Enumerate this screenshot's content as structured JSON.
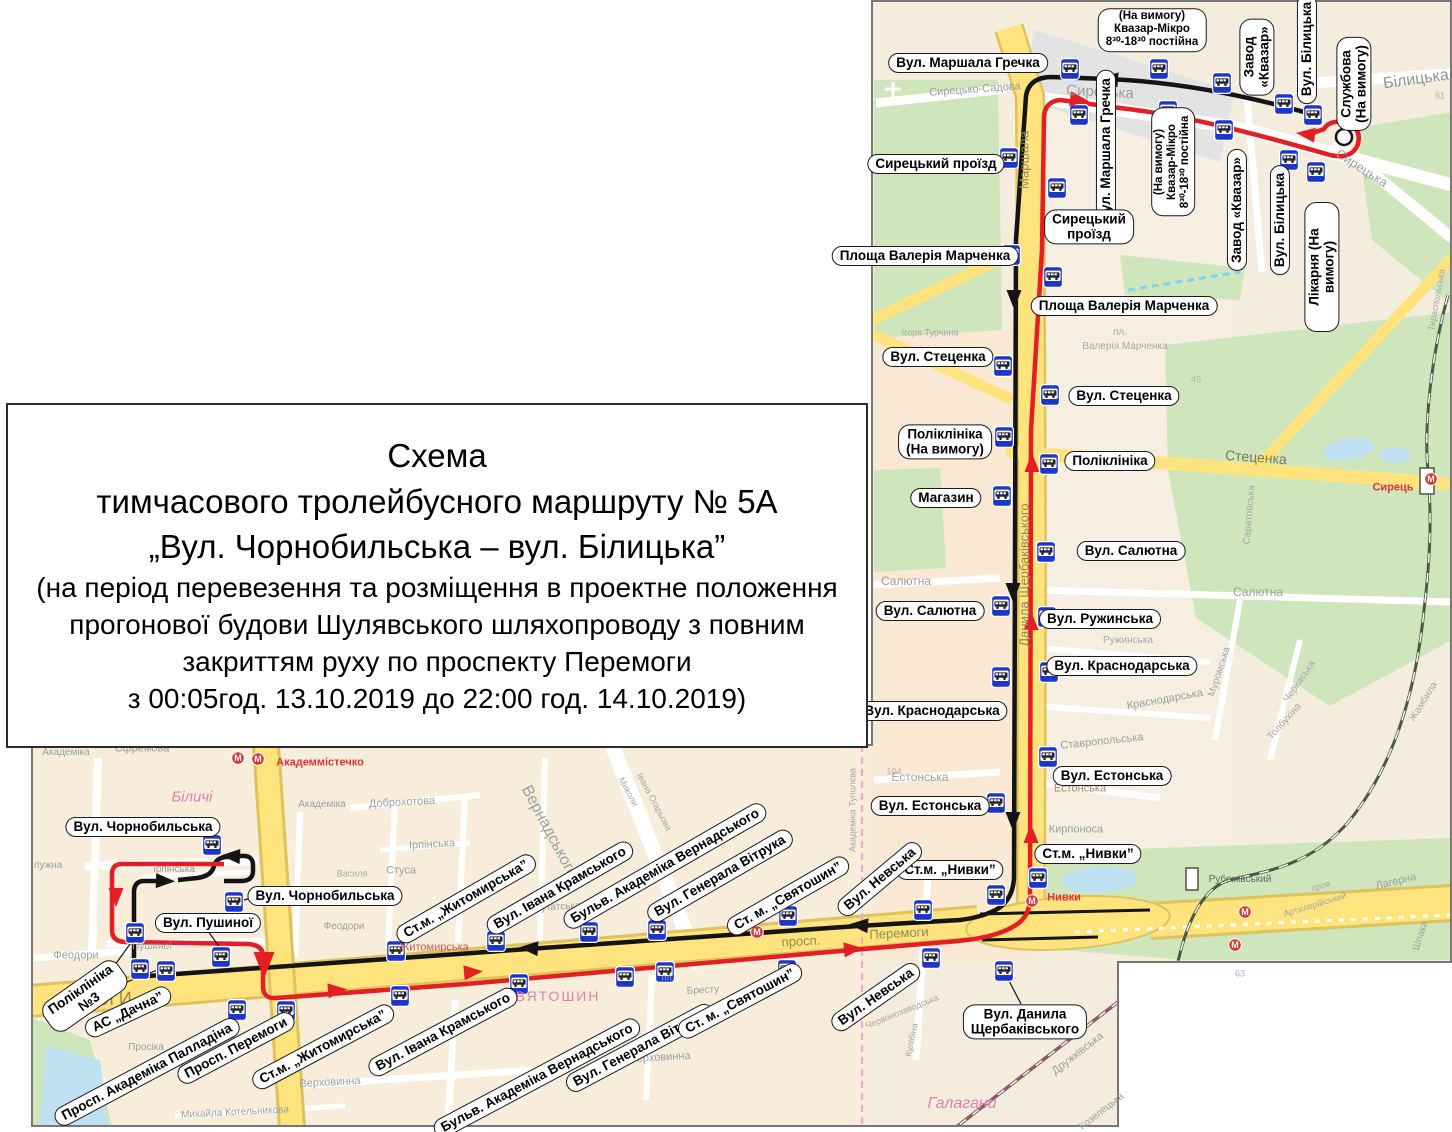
{
  "title_box": {
    "lines": [
      "Схема",
      "тимчасового тролейбусного маршруту  № 5А",
      "„Вул. Чорнобильська – вул. Білицька”",
      "(на період перевезення та розміщення в проектне положення",
      "прогонової будови Шулявського шляхопроводу з повним",
      "закриттям руху по проспекту Перемоги",
      "з 00:05год. 13.10.2019 до 22:00 год. 14.10.2019)"
    ]
  },
  "colors": {
    "route_outbound": "#141414",
    "route_return": "#e31e24",
    "road_main": "#ffe37d",
    "road_casing": "#ddc35e",
    "park_green": "#cfe6bc",
    "water_blue": "#bfe0f0",
    "label_border": "#1a1a1a"
  },
  "map": {
    "stop_labels": [
      {
        "t": "Вул. Маршала Гречка",
        "x": 968,
        "y": 63,
        "r": 0
      },
      {
        "t": "Сирецький проїзд",
        "x": 936,
        "y": 164,
        "r": 0
      },
      {
        "t": "Площа Валерія Марченка",
        "x": 925,
        "y": 256,
        "r": 0
      },
      {
        "t": "Вул. Стеценка",
        "x": 938,
        "y": 357,
        "r": 0
      },
      {
        "t": "Поліклініка\n(На вимогу)",
        "x": 945,
        "y": 442,
        "r": 0
      },
      {
        "t": "Магазин",
        "x": 946,
        "y": 498,
        "r": 0
      },
      {
        "t": "Вул. Салютна",
        "x": 930,
        "y": 611,
        "r": 0
      },
      {
        "t": "Вул. Краснодарська",
        "x": 932,
        "y": 711,
        "r": 0
      },
      {
        "t": "Вул. Естонська",
        "x": 930,
        "y": 806,
        "r": 0
      },
      {
        "t": "Ст.м. „Нивки”",
        "x": 950,
        "y": 870,
        "r": 0
      },
      {
        "t": "Вул. Маршала Гречка",
        "x": 1106,
        "y": 150,
        "r": -90
      },
      {
        "t": "(На вимогу)\nКвазар-Мікро\n8³⁰-18³⁰ постійна",
        "x": 1173,
        "y": 162,
        "r": -90,
        "fs": 11.5
      },
      {
        "t": "Сирецький\nпроїзд",
        "x": 1089,
        "y": 227,
        "r": 0
      },
      {
        "t": "Площа Валерія Марченка",
        "x": 1124,
        "y": 306,
        "r": 0
      },
      {
        "t": "Вул. Стеценка",
        "x": 1124,
        "y": 396,
        "r": 0
      },
      {
        "t": "Поліклініка",
        "x": 1110,
        "y": 461,
        "r": 0
      },
      {
        "t": "Вул. Салютна",
        "x": 1131,
        "y": 551,
        "r": 0
      },
      {
        "t": "Вул. Ружинська",
        "x": 1100,
        "y": 619,
        "r": 0
      },
      {
        "t": "Вул. Краснодарська",
        "x": 1122,
        "y": 666,
        "r": 0
      },
      {
        "t": "Вул. Естонська",
        "x": 1112,
        "y": 776,
        "r": 0
      },
      {
        "t": "Ст.м. „Нивки”",
        "x": 1088,
        "y": 854,
        "r": 0
      },
      {
        "t": "Вул. Данила\nЩербаківського",
        "x": 1025,
        "y": 1022,
        "r": 0
      },
      {
        "t": "(На вимогу)\nКвазар-Мікро\n8³⁰-18³⁰ постійна",
        "x": 1152,
        "y": 30,
        "r": 0,
        "fs": 11.5
      },
      {
        "t": "Завод\n«Квазар»",
        "x": 1257,
        "y": 57,
        "r": -90
      },
      {
        "t": "Вул. Білицька",
        "x": 1307,
        "y": 49,
        "r": -90
      },
      {
        "t": "Службова\n(На вимогу)",
        "x": 1354,
        "y": 84,
        "r": -90
      },
      {
        "t": "Завод «Квазар»",
        "x": 1237,
        "y": 210,
        "r": -90
      },
      {
        "t": "Вул. Білицька",
        "x": 1280,
        "y": 220,
        "r": -90
      },
      {
        "t": "Лікарня (На вимогу)",
        "x": 1322,
        "y": 267,
        "r": -90
      },
      {
        "t": "Вул. Чорнобильська",
        "x": 143,
        "y": 827,
        "r": 0
      },
      {
        "t": "Вул. Чорнобильська",
        "x": 325,
        "y": 896,
        "r": 0
      },
      {
        "t": "Вул. Пушиної",
        "x": 208,
        "y": 923,
        "r": 0
      },
      {
        "t": "Поліклініка\n№3",
        "x": 85,
        "y": 996,
        "r": -35
      },
      {
        "t": "АС „Дачна”",
        "x": 128,
        "y": 1012,
        "r": -25
      },
      {
        "t": "Просп. Академіка Палладіна",
        "x": 147,
        "y": 1072,
        "r": -28
      },
      {
        "t": "Просп. Перемоги",
        "x": 236,
        "y": 1048,
        "r": -28
      },
      {
        "t": "Ст.м. „Житомирська”",
        "x": 323,
        "y": 1047,
        "r": -28
      },
      {
        "t": "Вул. Івана Крамського",
        "x": 443,
        "y": 1032,
        "r": -28
      },
      {
        "t": "Бульв. Академіка Вернадського",
        "x": 537,
        "y": 1078,
        "r": -28
      },
      {
        "t": "Вул. Генерала Вітрука",
        "x": 640,
        "y": 1048,
        "r": -28
      },
      {
        "t": "Ст. м. „Святошин”",
        "x": 740,
        "y": 1001,
        "r": -28
      },
      {
        "t": "Вул. Невська",
        "x": 876,
        "y": 997,
        "r": -35
      },
      {
        "t": "Ст.м. „Житомирська”",
        "x": 466,
        "y": 899,
        "r": -30
      },
      {
        "t": "Вул. Івана Крамського",
        "x": 560,
        "y": 888,
        "r": -30
      },
      {
        "t": "Бульв. Академіка Вернадського",
        "x": 665,
        "y": 866,
        "r": -30
      },
      {
        "t": "Вул. Генерала Вітрука",
        "x": 720,
        "y": 876,
        "r": -30
      },
      {
        "t": "Ст. м. „Святошин”",
        "x": 788,
        "y": 896,
        "r": -30
      },
      {
        "t": "Вул. Невська",
        "x": 880,
        "y": 879,
        "r": -40
      }
    ],
    "street_names": [
      {
        "t": "Сирецько-Садова",
        "x": 975,
        "y": 90,
        "r": -4,
        "s": 11,
        "c": "#9aa0a0"
      },
      {
        "t": "Сирецька",
        "x": 1100,
        "y": 92,
        "r": 3,
        "s": 15,
        "c": "#9aa0a0"
      },
      {
        "t": "Сирецька",
        "x": 1362,
        "y": 168,
        "r": 33,
        "s": 13,
        "c": "#9aa0a0"
      },
      {
        "t": "Білицька",
        "x": 1416,
        "y": 80,
        "r": -8,
        "s": 16,
        "c": "#8f968f"
      },
      {
        "t": "Маршала",
        "x": 1024,
        "y": 160,
        "r": -90,
        "s": 13,
        "c": "#8f8a5a"
      },
      {
        "t": "Данила Щербаківського",
        "x": 1024,
        "y": 575,
        "r": -90,
        "s": 13,
        "c": "#8f8a5a"
      },
      {
        "t": "Стеценка",
        "x": 1256,
        "y": 457,
        "r": 4,
        "s": 14,
        "c": "#7d7a4e"
      },
      {
        "t": "Ігоря Турчина",
        "x": 930,
        "y": 333,
        "r": 0,
        "s": 9,
        "c": "#a8a8a8"
      },
      {
        "t": "пл.",
        "x": 1120,
        "y": 333,
        "r": 0,
        "s": 10,
        "c": "#a8a8a8"
      },
      {
        "t": "Валерія Марченка",
        "x": 1125,
        "y": 347,
        "r": 0,
        "s": 10,
        "c": "#a8a8a8"
      },
      {
        "t": "Салютна",
        "x": 906,
        "y": 581,
        "r": 0,
        "s": 12,
        "c": "#9aa0a0"
      },
      {
        "t": "Салютна",
        "x": 1258,
        "y": 592,
        "r": 0,
        "s": 12,
        "c": "#9aa0a0"
      },
      {
        "t": "Саратовська",
        "x": 1250,
        "y": 515,
        "r": -85,
        "s": 10,
        "c": "#a8a8a8"
      },
      {
        "t": "Ружинська",
        "x": 1128,
        "y": 641,
        "r": 0,
        "s": 10,
        "c": "#a8a8a8"
      },
      {
        "t": "Краснодарська",
        "x": 1165,
        "y": 700,
        "r": -10,
        "s": 11,
        "c": "#9aa0a0"
      },
      {
        "t": "Ставропольська",
        "x": 1102,
        "y": 742,
        "r": -6,
        "s": 11,
        "c": "#9aa0a0"
      },
      {
        "t": "Естонська",
        "x": 920,
        "y": 777,
        "r": 0,
        "s": 12,
        "c": "#9aa0a0"
      },
      {
        "t": "Естонська",
        "x": 1080,
        "y": 789,
        "r": 0,
        "s": 11,
        "c": "#b5825a"
      },
      {
        "t": "Кирпоноса",
        "x": 1076,
        "y": 830,
        "r": 0,
        "s": 11,
        "c": "#9aa0a0"
      },
      {
        "t": "Нивки",
        "x": 1064,
        "y": 898,
        "r": 0,
        "s": 11,
        "c": "#e03434",
        "w": 1
      },
      {
        "t": "Сирець",
        "x": 1393,
        "y": 488,
        "r": 0,
        "s": 11,
        "c": "#e03434",
        "w": 1
      },
      {
        "t": "Рубежівський",
        "x": 1240,
        "y": 880,
        "r": 0,
        "s": 10,
        "c": "#666666"
      },
      {
        "t": "пров.",
        "x": 1322,
        "y": 886,
        "r": -17,
        "s": 9,
        "c": "#a8a8a8"
      },
      {
        "t": "Артилерійський",
        "x": 1315,
        "y": 905,
        "r": -17,
        "s": 9,
        "c": "#a8a8a8"
      },
      {
        "t": "Лагерна",
        "x": 1396,
        "y": 882,
        "r": -14,
        "s": 11,
        "c": "#9aa0a0"
      },
      {
        "t": "Шпака",
        "x": 1421,
        "y": 936,
        "r": -72,
        "s": 10,
        "c": "#9aa0a0"
      },
      {
        "t": "Тираспольська",
        "x": 1437,
        "y": 300,
        "r": -80,
        "s": 9,
        "c": "#a8a8a8"
      },
      {
        "t": "Муромська",
        "x": 1220,
        "y": 672,
        "r": -72,
        "s": 10,
        "c": "#a8a8a8"
      },
      {
        "t": "Черкаська",
        "x": 1300,
        "y": 682,
        "r": -55,
        "s": 10,
        "c": "#a8a8a8"
      },
      {
        "t": "Толбухіна",
        "x": 1285,
        "y": 722,
        "r": -48,
        "s": 10,
        "c": "#a8a8a8"
      },
      {
        "t": "Жамбила",
        "x": 1424,
        "y": 702,
        "r": -58,
        "s": 10,
        "c": "#a8a8a8"
      },
      {
        "t": "Перемоги",
        "x": 899,
        "y": 933,
        "r": -3,
        "s": 13,
        "c": "#8f8a5a"
      },
      {
        "t": "просп.",
        "x": 801,
        "y": 941,
        "r": -3,
        "s": 13,
        "c": "#8f8a5a"
      },
      {
        "t": "49",
        "x": 1196,
        "y": 380,
        "r": 0,
        "s": 9,
        "c": "#b0b0b0"
      },
      {
        "t": "61",
        "x": 1440,
        "y": 96,
        "r": 0,
        "s": 9,
        "c": "#b0b0b0"
      },
      {
        "t": "63",
        "x": 1240,
        "y": 974,
        "r": 0,
        "s": 9,
        "c": "#b0b0b0"
      },
      {
        "t": "104",
        "x": 894,
        "y": 772,
        "r": 0,
        "s": 9,
        "c": "#b0b0b0"
      },
      {
        "t": "Академіка",
        "x": 66,
        "y": 753,
        "r": 0,
        "s": 10,
        "c": "#9aa0a0"
      },
      {
        "t": "Єфремова",
        "x": 142,
        "y": 749,
        "r": 0,
        "s": 11,
        "c": "#9aa0a0"
      },
      {
        "t": "Біличі",
        "x": 192,
        "y": 797,
        "r": 0,
        "s": 15,
        "c": "#e080b0",
        "i": 1
      },
      {
        "t": "Академмістечко",
        "x": 320,
        "y": 763,
        "r": 0,
        "s": 11,
        "c": "#e03434",
        "w": 1
      },
      {
        "t": "Академіка",
        "x": 322,
        "y": 805,
        "r": 0,
        "s": 10,
        "c": "#9aa0a0"
      },
      {
        "t": "Доброхотова",
        "x": 402,
        "y": 803,
        "r": -3,
        "s": 11,
        "c": "#9aa0a0"
      },
      {
        "t": "Ірпінська",
        "x": 432,
        "y": 845,
        "r": -3,
        "s": 11,
        "c": "#9aa0a0"
      },
      {
        "t": "Стуса",
        "x": 401,
        "y": 871,
        "r": 0,
        "s": 11,
        "c": "#9aa0a0"
      },
      {
        "t": "Василя",
        "x": 352,
        "y": 874,
        "r": 0,
        "s": 9,
        "c": "#a8a8a8"
      },
      {
        "t": "Вернадського",
        "x": 549,
        "y": 832,
        "r": 62,
        "s": 16,
        "c": "#9aa0a0"
      },
      {
        "t": "Миколи",
        "x": 628,
        "y": 792,
        "r": 62,
        "s": 9,
        "c": "#a8a8a8"
      },
      {
        "t": "Івана Огарьова",
        "x": 654,
        "y": 802,
        "r": 62,
        "s": 9,
        "c": "#a8a8a8"
      },
      {
        "t": "Депутатська",
        "x": 552,
        "y": 908,
        "r": -3,
        "s": 10,
        "c": "#9aa0a0"
      },
      {
        "t": "Житомирська",
        "x": 434,
        "y": 948,
        "r": 0,
        "s": 11,
        "c": "#c06050"
      },
      {
        "t": "СВЯТОШИН",
        "x": 552,
        "y": 996,
        "r": 0,
        "s": 14,
        "c": "#e080b0",
        "ls": 2
      },
      {
        "t": "Верховинна",
        "x": 330,
        "y": 1083,
        "r": -3,
        "s": 11,
        "c": "#9aa0a0"
      },
      {
        "t": "Верховинна",
        "x": 660,
        "y": 1058,
        "r": -3,
        "s": 11,
        "c": "#9aa0a0"
      },
      {
        "t": "Михайла Котельникова",
        "x": 235,
        "y": 1113,
        "r": -3,
        "s": 10,
        "c": "#9aa0a0"
      },
      {
        "t": "Просіка",
        "x": 146,
        "y": 1048,
        "r": 0,
        "s": 10,
        "c": "#9aa0a0"
      },
      {
        "t": "Феодори",
        "x": 76,
        "y": 956,
        "r": 0,
        "s": 11,
        "c": "#9aa0a0"
      },
      {
        "t": "Феодори",
        "x": 344,
        "y": 927,
        "r": 0,
        "s": 10,
        "c": "#9aa0a0"
      },
      {
        "t": "Пушиної",
        "x": 152,
        "y": 947,
        "r": 0,
        "s": 10,
        "c": "#9aa0a0"
      },
      {
        "t": "Ірпінська",
        "x": 174,
        "y": 870,
        "r": 0,
        "s": 10,
        "c": "#9aa0a0"
      },
      {
        "t": "лужна",
        "x": 48,
        "y": 866,
        "r": 0,
        "s": 10,
        "c": "#9aa0a0"
      },
      {
        "t": "Бресту",
        "x": 703,
        "y": 991,
        "r": -3,
        "s": 10,
        "c": "#9aa0a0"
      },
      {
        "t": "пл.",
        "x": 668,
        "y": 978,
        "r": 0,
        "s": 9,
        "c": "#9aa0a0"
      },
      {
        "t": "Галагани",
        "x": 962,
        "y": 1104,
        "r": 0,
        "s": 16,
        "c": "#e080b0",
        "i": 1
      },
      {
        "t": "Червонозаводська",
        "x": 902,
        "y": 1012,
        "r": -22,
        "s": 9,
        "c": "#a8a8a8"
      },
      {
        "t": "Кулібіна",
        "x": 912,
        "y": 1040,
        "r": -78,
        "s": 9,
        "c": "#a8a8a8"
      },
      {
        "t": "Дружківська",
        "x": 1078,
        "y": 1054,
        "r": -38,
        "s": 11,
        "c": "#9aa0a0"
      },
      {
        "t": "Козелецька",
        "x": 1102,
        "y": 1112,
        "r": -38,
        "s": 10,
        "c": "#9aa0a0"
      },
      {
        "t": "Академіка Туполєва",
        "x": 853,
        "y": 810,
        "r": -90,
        "s": 9,
        "c": "#a8a8a8"
      },
      {
        "t": "МОГИ",
        "x": 106,
        "y": 999,
        "r": -2,
        "s": 18,
        "c": "#8f8a5a"
      }
    ],
    "stops": [
      [
        1070,
        69
      ],
      [
        1009,
        158
      ],
      [
        1011,
        255
      ],
      [
        1003,
        366
      ],
      [
        1004,
        437
      ],
      [
        1002,
        496
      ],
      [
        1001,
        606
      ],
      [
        1001,
        677
      ],
      [
        996,
        803
      ],
      [
        996,
        895
      ],
      [
        923,
        910
      ],
      [
        1159,
        69
      ],
      [
        1222,
        83
      ],
      [
        1284,
        104
      ],
      [
        1313,
        115
      ],
      [
        1079,
        115
      ],
      [
        1168,
        111
      ],
      [
        1057,
        188
      ],
      [
        1053,
        277
      ],
      [
        1050,
        395
      ],
      [
        1049,
        464
      ],
      [
        1046,
        552
      ],
      [
        1047,
        617
      ],
      [
        1049,
        672
      ],
      [
        1048,
        757
      ],
      [
        1038,
        878
      ],
      [
        1224,
        130
      ],
      [
        1289,
        160
      ],
      [
        1316,
        172
      ],
      [
        1004,
        971
      ],
      [
        212,
        845
      ],
      [
        234,
        902
      ],
      [
        135,
        933
      ],
      [
        221,
        957
      ],
      [
        140,
        969
      ],
      [
        166,
        971
      ],
      [
        237,
        1010
      ],
      [
        286,
        1011
      ],
      [
        396,
        951
      ],
      [
        496,
        941
      ],
      [
        589,
        932
      ],
      [
        657,
        930
      ],
      [
        788,
        916
      ],
      [
        400,
        996
      ],
      [
        519,
        984
      ],
      [
        625,
        977
      ],
      [
        665,
        972
      ],
      [
        787,
        970
      ],
      [
        931,
        958
      ]
    ],
    "metro_stations": [
      [
        238,
        758
      ],
      [
        258,
        759
      ],
      [
        1032,
        901
      ],
      [
        1245,
        912
      ],
      [
        1235,
        945
      ],
      [
        1431,
        479
      ],
      [
        757,
        932
      ]
    ],
    "route_arrows": [
      {
        "x": 1108,
        "y": 79,
        "r": 185,
        "route": "out"
      },
      {
        "x": 1014,
        "y": 300,
        "r": 90,
        "route": "out"
      },
      {
        "x": 1013,
        "y": 593,
        "r": 90,
        "route": "out"
      },
      {
        "x": 1013,
        "y": 822,
        "r": 90,
        "route": "out"
      },
      {
        "x": 858,
        "y": 925,
        "r": 184,
        "route": "out"
      },
      {
        "x": 528,
        "y": 948,
        "r": 184,
        "route": "out"
      },
      {
        "x": 166,
        "y": 881,
        "r": 2,
        "route": "out"
      },
      {
        "x": 230,
        "y": 856,
        "r": 183,
        "route": "out"
      },
      {
        "x": 116,
        "y": 898,
        "r": 90,
        "route": "ret"
      },
      {
        "x": 264,
        "y": 966,
        "r": 90,
        "route": "ret",
        "s": 1.4
      },
      {
        "x": 338,
        "y": 990,
        "r": -5,
        "route": "ret"
      },
      {
        "x": 474,
        "y": 972,
        "r": -5,
        "route": "ret"
      },
      {
        "x": 854,
        "y": 949,
        "r": -5,
        "route": "ret"
      },
      {
        "x": 1031,
        "y": 833,
        "r": -90,
        "route": "ret"
      },
      {
        "x": 1031,
        "y": 620,
        "r": -90,
        "route": "ret"
      },
      {
        "x": 1032,
        "y": 462,
        "r": -90,
        "route": "ret"
      },
      {
        "x": 1080,
        "y": 100,
        "r": 7,
        "route": "ret"
      },
      {
        "x": 1305,
        "y": 134,
        "r": 187,
        "route": "ret"
      }
    ],
    "terminal_loop": {
      "x": 1344,
      "y": 137,
      "r": 8
    }
  }
}
